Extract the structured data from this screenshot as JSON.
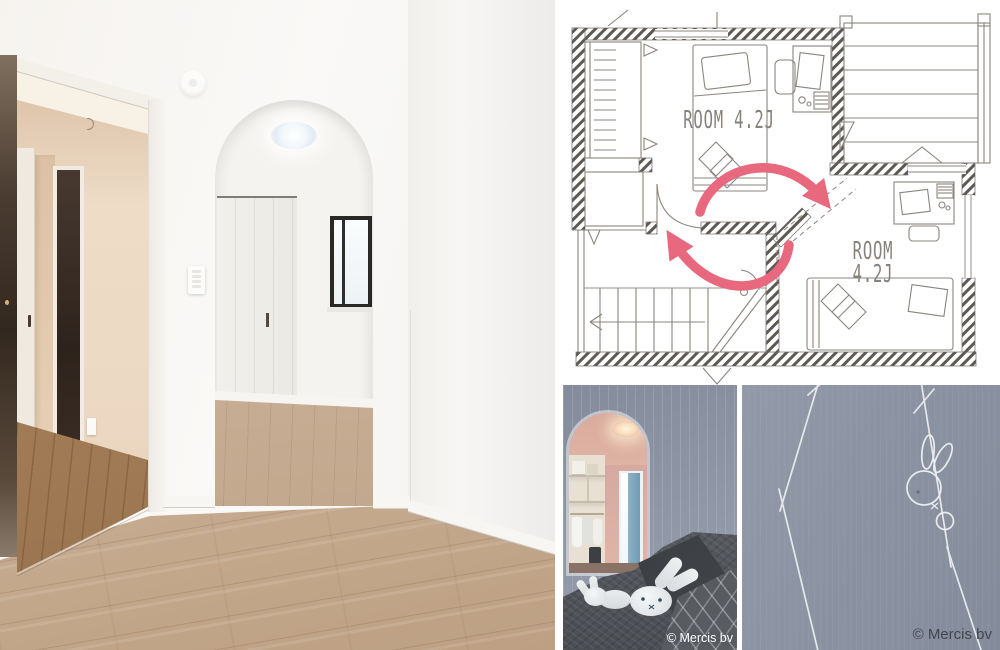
{
  "collage": {
    "background": "#ffffff",
    "gap_color": "#ffffff"
  },
  "floor_plan": {
    "ink_color": "#8a857f",
    "wall_hatch_color": "#5e5953",
    "swap_arrow_color": "#e8697e",
    "room_top": {
      "label": "ROOM 4.2J"
    },
    "room_right": {
      "label_line1": "ROOM",
      "label_line2": "4.2J"
    }
  },
  "photos": {
    "left_room": {
      "description": "White room with arched doorway, open hallway door, wood flooring"
    },
    "bedroom": {
      "description": "Bedroom with arched walk-in closet and Miffy plush toys on dark bedding",
      "wallpaper_color": "#8e96a6",
      "copyright": "© Mercis bv"
    },
    "wallpaper": {
      "description": "Close-up of gray-blue wallpaper with Miffy line pattern",
      "base_color": "#8d95a4",
      "line_color": "#eef0f2",
      "copyright": "© Mercis bv"
    }
  }
}
